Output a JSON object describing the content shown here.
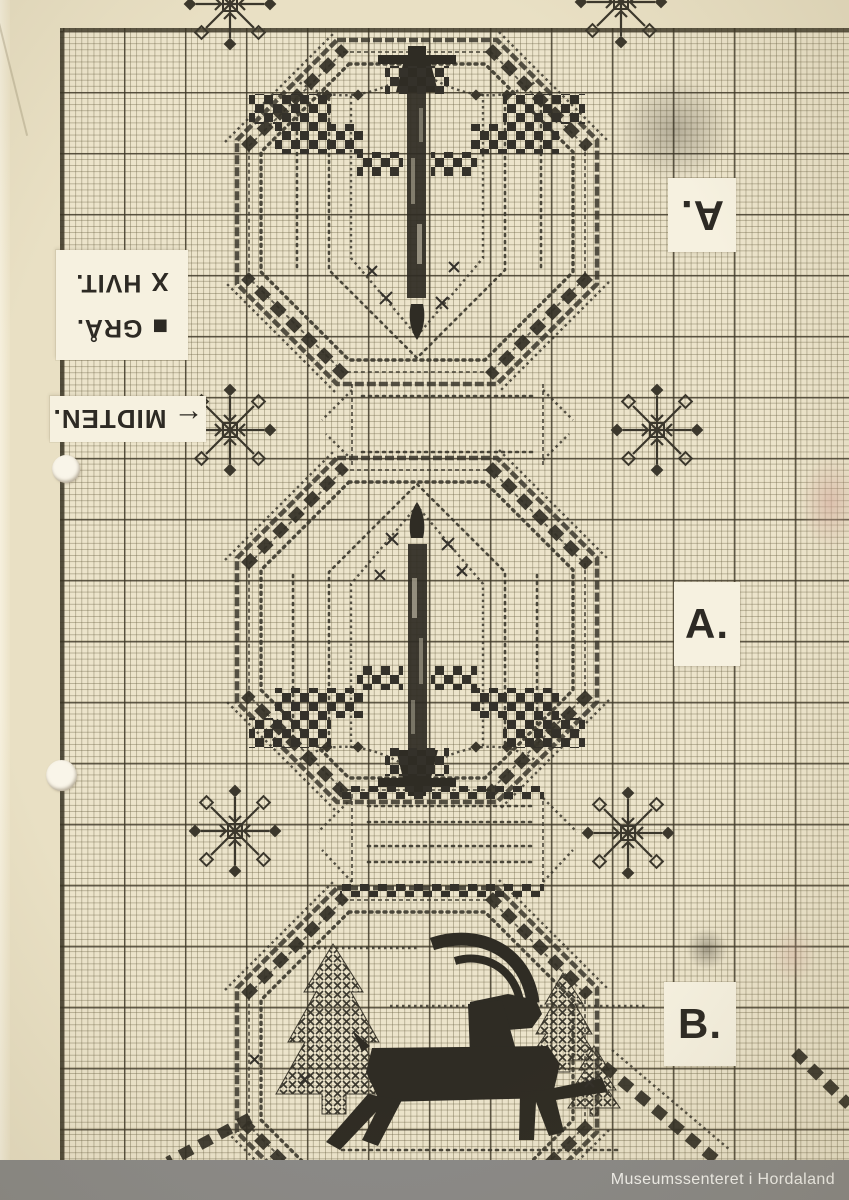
{
  "labels": {
    "top_section": "A.",
    "middle_section": "A.",
    "bottom_section": "B."
  },
  "legend": {
    "items": [
      {
        "symbol": "X",
        "label": "HVIT."
      },
      {
        "symbol": "■",
        "label": "GRÅ."
      }
    ]
  },
  "center_marker": {
    "arrow": "←",
    "text": "MIDTEN."
  },
  "footer": {
    "watermark": "Museumssenteret i Hordaland"
  },
  "colors": {
    "paper": "#ece4cb",
    "stitch": "#322f25",
    "grid_major": "#3a3424",
    "grid_minor": "#685f42",
    "footer_bar": "#8b8a88",
    "label_slip": "#f6f1e0"
  },
  "motifs": {
    "top_medallion": "inverted-candle",
    "middle_medallion": "candle",
    "bottom_medallion": "yule-goat-with-trees",
    "separators": "snowflakes"
  }
}
